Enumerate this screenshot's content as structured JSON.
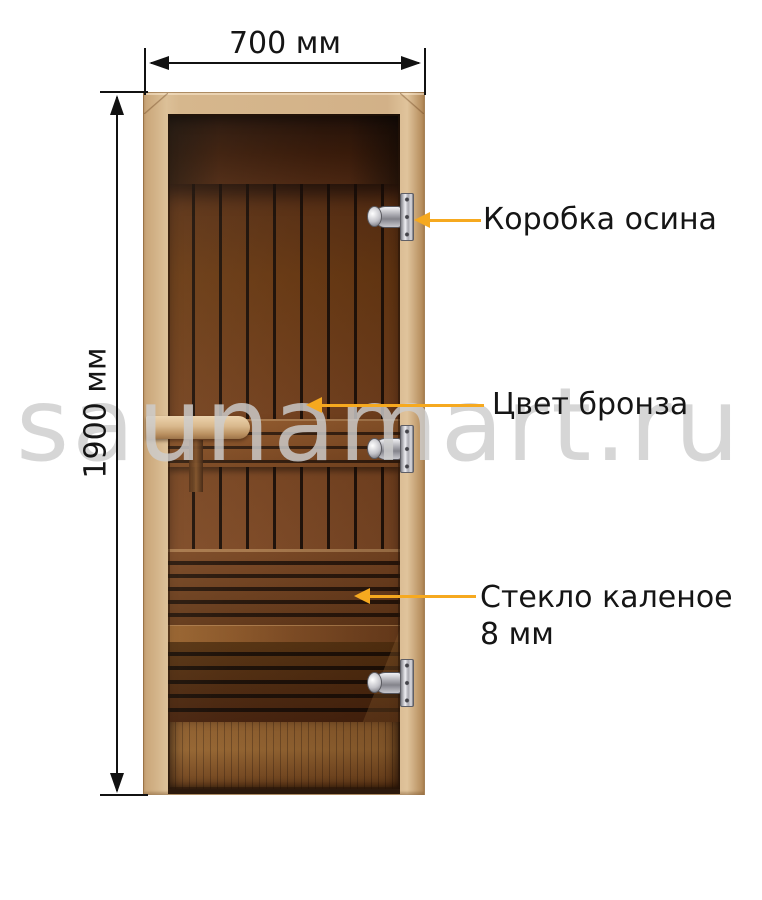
{
  "dimensions": {
    "width": "700 мм",
    "height": "1900 мм"
  },
  "callouts": {
    "frame": {
      "label": "Коробка осина"
    },
    "tint": {
      "label": "Цвет бронза"
    },
    "glass": {
      "line1": "Стекло каленое",
      "line2": "8 мм"
    }
  },
  "watermark": {
    "text": "saunamart.ru"
  },
  "door": {
    "hinge_count": 3
  },
  "colors": {
    "callout_arrow": "#F6A91F",
    "dimension": "#111111",
    "label_text": "#151515",
    "watermark": "#D2D2D2",
    "frame_wood": "#D2B188",
    "glass_tint_dark": "#3A1A0C",
    "interior_plank": "#6F3D1B",
    "hinge_chrome": "#C9C9CF"
  }
}
